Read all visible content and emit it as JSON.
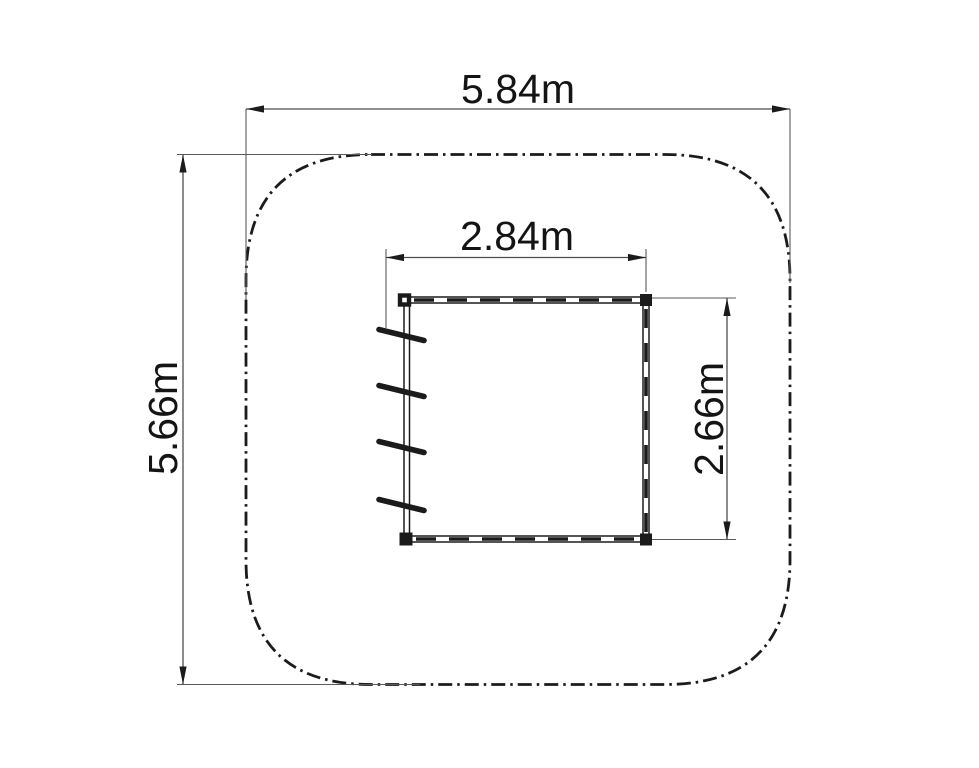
{
  "drawing": {
    "description": "Plan-view technical drawing: playground equipment footprint inside a rounded-square safety zone",
    "safety_zone": {
      "width_label": "5.84m",
      "height_label": "5.66m",
      "outline_style": "dash-dot"
    },
    "equipment": {
      "width_label": "2.84m",
      "height_label": "2.66m",
      "rung_count": 4,
      "corner_posts": 4
    },
    "colors": {
      "background": "#ffffff",
      "line": "#1b1b1b",
      "dimension_line": "#4d4d4d",
      "text": "#141414"
    }
  }
}
